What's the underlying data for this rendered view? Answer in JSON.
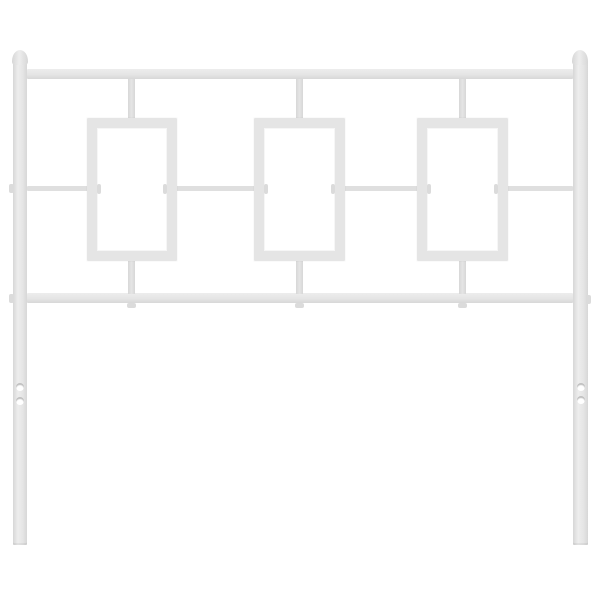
{
  "scene": {
    "type": "product-photo",
    "subject": "white metal headboard with three rectangular frame cutouts",
    "text_content": "none"
  },
  "colors": {
    "background": "#ffffff",
    "metal": "#e5e5e5",
    "metal_hi": "#ededed",
    "metal_edge": "#d7d7d7",
    "metal_thin": "#dfdfdf",
    "metal_tab": "#dbdbdb",
    "hole_fill": "#ffffff",
    "hole_shadow": "rgba(148,148,148,0.6)"
  },
  "parts": [
    {
      "name": "left-post",
      "kind": "post",
      "x": 13,
      "y": 60,
      "w": 14,
      "h": 485
    },
    {
      "name": "right-post",
      "kind": "post",
      "x": 573,
      "y": 60,
      "w": 15,
      "h": 485
    },
    {
      "name": "top-rail",
      "kind": "rail",
      "x": 27,
      "y": 69,
      "w": 546,
      "h": 10
    },
    {
      "name": "bottom-rail",
      "kind": "rail",
      "x": 27,
      "y": 293,
      "w": 546,
      "h": 10
    },
    {
      "name": "middle-rail-segment-1",
      "kind": "rail-thin",
      "x": 27,
      "y": 186,
      "w": 62,
      "h": 5
    },
    {
      "name": "middle-rail-segment-2",
      "kind": "rail-thin",
      "x": 175,
      "y": 186,
      "w": 81,
      "h": 5
    },
    {
      "name": "middle-rail-segment-3",
      "kind": "rail-thin",
      "x": 343,
      "y": 186,
      "w": 76,
      "h": 5
    },
    {
      "name": "middle-rail-segment-4",
      "kind": "rail-thin",
      "x": 506,
      "y": 186,
      "w": 67,
      "h": 5
    },
    {
      "name": "top-connector-left",
      "kind": "connector",
      "x": 128,
      "y": 79,
      "w": 7,
      "h": 40
    },
    {
      "name": "top-connector-center",
      "kind": "connector",
      "x": 296,
      "y": 79,
      "w": 7,
      "h": 40
    },
    {
      "name": "top-connector-right",
      "kind": "connector",
      "x": 459,
      "y": 79,
      "w": 7,
      "h": 40
    },
    {
      "name": "bottom-connector-left",
      "kind": "connector",
      "x": 128,
      "y": 260,
      "w": 7,
      "h": 34
    },
    {
      "name": "bottom-connector-center",
      "kind": "connector",
      "x": 296,
      "y": 260,
      "w": 7,
      "h": 34
    },
    {
      "name": "bottom-connector-right",
      "kind": "connector",
      "x": 459,
      "y": 260,
      "w": 7,
      "h": 34
    },
    {
      "name": "frame-left",
      "kind": "frame",
      "x": 87,
      "y": 118,
      "w": 90,
      "h": 143,
      "bw": 10
    },
    {
      "name": "frame-center",
      "kind": "frame",
      "x": 254,
      "y": 118,
      "w": 91,
      "h": 143,
      "bw": 10
    },
    {
      "name": "frame-right",
      "kind": "frame",
      "x": 417,
      "y": 118,
      "w": 91,
      "h": 143,
      "bw": 10
    },
    {
      "name": "frame-left-inner-nub-left",
      "kind": "tab",
      "x": 97,
      "y": 184,
      "w": 4,
      "h": 10
    },
    {
      "name": "frame-left-inner-nub-right",
      "kind": "tab",
      "x": 163,
      "y": 184,
      "w": 4,
      "h": 10
    },
    {
      "name": "frame-center-inner-nub-left",
      "kind": "tab",
      "x": 264,
      "y": 184,
      "w": 4,
      "h": 10
    },
    {
      "name": "frame-center-inner-nub-right",
      "kind": "tab",
      "x": 331,
      "y": 184,
      "w": 4,
      "h": 10
    },
    {
      "name": "frame-right-inner-nub-left",
      "kind": "tab",
      "x": 427,
      "y": 184,
      "w": 4,
      "h": 10
    },
    {
      "name": "frame-right-inner-nub-right",
      "kind": "tab",
      "x": 494,
      "y": 184,
      "w": 4,
      "h": 10
    },
    {
      "name": "tab-below-rail-left",
      "kind": "tab",
      "x": 127,
      "y": 303,
      "w": 9,
      "h": 5
    },
    {
      "name": "tab-below-rail-center",
      "kind": "tab",
      "x": 295,
      "y": 303,
      "w": 9,
      "h": 5
    },
    {
      "name": "tab-below-rail-right",
      "kind": "tab",
      "x": 458,
      "y": 303,
      "w": 9,
      "h": 5
    },
    {
      "name": "left-post-nub-mid",
      "kind": "tab",
      "x": 9,
      "y": 184,
      "w": 5,
      "h": 9
    },
    {
      "name": "left-post-nub-bottom",
      "kind": "tab",
      "x": 9,
      "y": 294,
      "w": 5,
      "h": 9
    },
    {
      "name": "right-post-nub-bottom",
      "kind": "tab",
      "x": 586,
      "y": 295,
      "w": 5,
      "h": 9
    },
    {
      "name": "left-finial",
      "kind": "finial",
      "x": 12,
      "y": 50,
      "w": 16,
      "h": 15
    },
    {
      "name": "right-finial",
      "kind": "finial",
      "x": 572,
      "y": 50,
      "w": 16,
      "h": 15
    },
    {
      "name": "left-leg-hole-upper",
      "kind": "hole",
      "x": 16,
      "y": 383,
      "w": 8,
      "h": 8
    },
    {
      "name": "left-leg-hole-lower",
      "kind": "hole",
      "x": 16,
      "y": 397,
      "w": 8,
      "h": 8
    },
    {
      "name": "right-leg-hole-upper",
      "kind": "hole",
      "x": 577,
      "y": 383,
      "w": 8,
      "h": 8
    },
    {
      "name": "right-leg-hole-lower",
      "kind": "hole",
      "x": 577,
      "y": 396,
      "w": 8,
      "h": 8
    }
  ]
}
